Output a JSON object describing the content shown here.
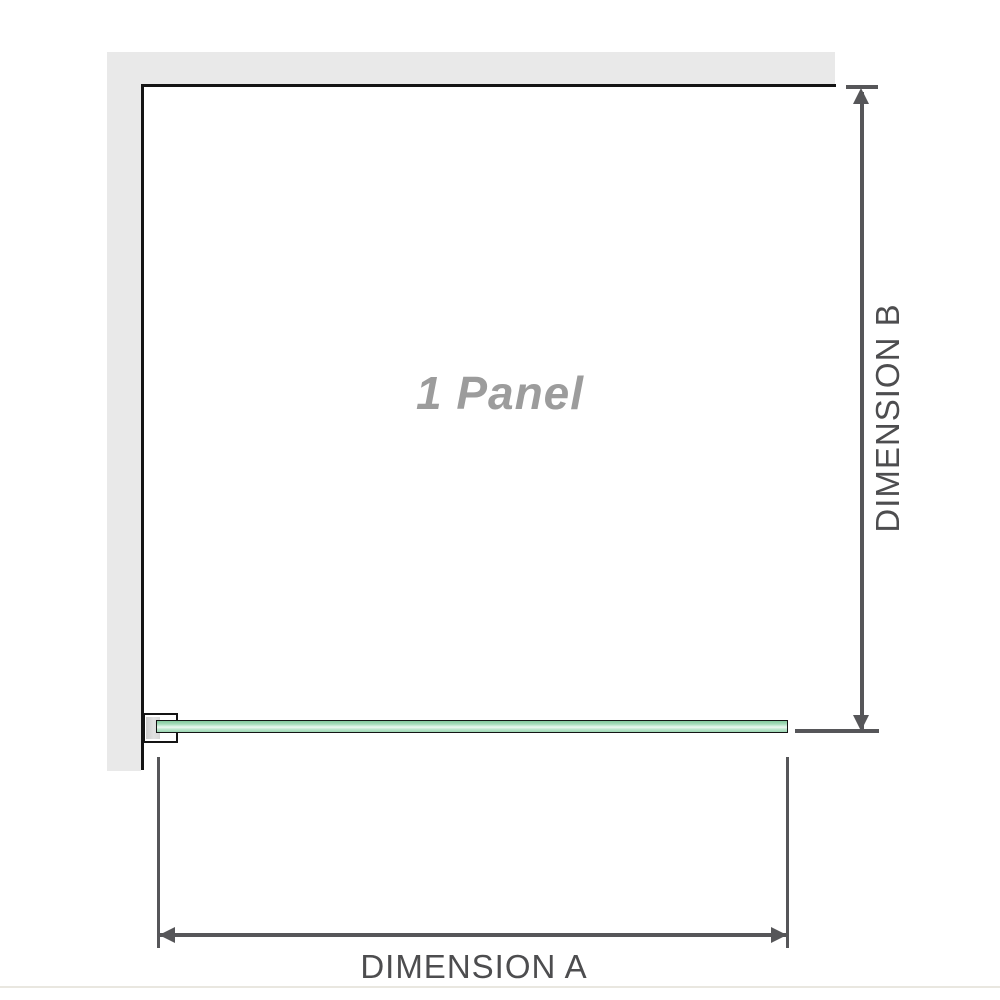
{
  "diagram": {
    "title": "1 Panel shower screen dimension diagram",
    "panel": {
      "label": "1 Panel"
    },
    "dimension_a": {
      "label": "DIMENSION A",
      "orientation": "horizontal"
    },
    "dimension_b": {
      "label": "DIMENSION B",
      "orientation": "vertical"
    }
  },
  "colors": {
    "background": "#ffffff",
    "wall_fill": "#e9e9e9",
    "panel_border": "#141414",
    "glass_green_dark": "#83c99d",
    "glass_green_light": "#edf8f1",
    "dimension_line": "#565659",
    "dimension_label_text": "#4d4d4f",
    "panel_label_text": "#9c9c9c",
    "bracket_pad": "#d6d6d6",
    "bottom_rule": "#e9e7e0"
  }
}
